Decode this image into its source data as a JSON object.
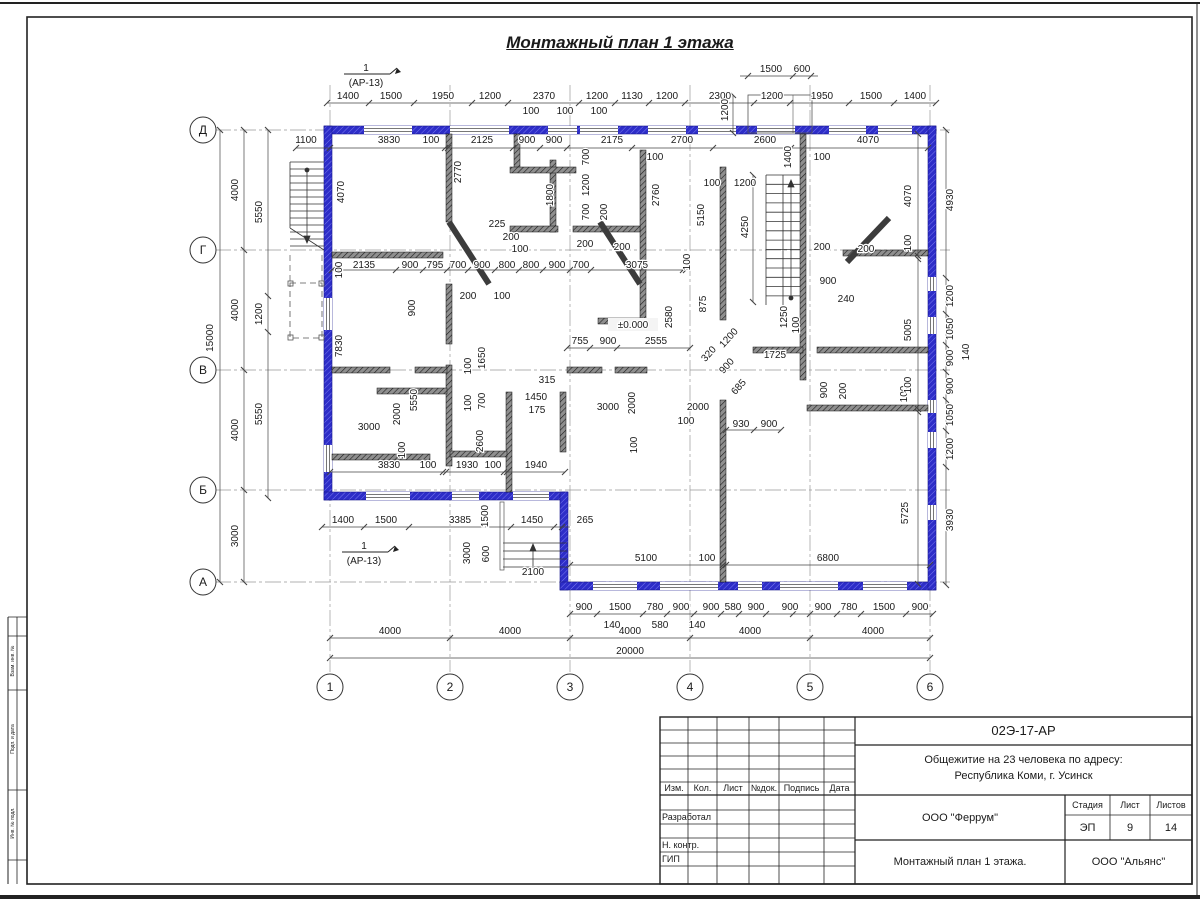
{
  "sheet": {
    "title": "Монтажный план 1 этажа",
    "stamp": {
      "doc_number": "02Э-17-АР",
      "project_line1": "Общежитие на 23 человека по адресу:",
      "project_line2": "Республика Коми, г. Усинск",
      "org_design": "ООО \"Феррум\"",
      "org_contractor": "ООО \"Альянс\"",
      "sheet_title": "Монтажный план 1 этажа.",
      "stage_label": "Стадия",
      "sheet_label": "Лист",
      "sheets_label": "Листов",
      "stage": "ЭП",
      "sheet_no": "9",
      "sheets_total": "14",
      "col_izm": "Изм.",
      "col_kol": "Кол.",
      "col_list": "Лист",
      "col_doc": "№док.",
      "col_sign": "Подпись",
      "col_date": "Дата",
      "row_developed": "Разработал",
      "row_ncontrol": "Н. контр.",
      "row_gip": "ГИП"
    },
    "side_labels": [
      "Взам. инв. №",
      "Подп. и дата",
      "Инв. № подл."
    ]
  },
  "plan": {
    "elevation": "±0.000",
    "section_marker": {
      "num": "1",
      "ref": "(АР-13)"
    },
    "axes": {
      "cols": [
        {
          "label": "1",
          "x": 330
        },
        {
          "label": "2",
          "x": 450
        },
        {
          "label": "3",
          "x": 570
        },
        {
          "label": "4",
          "x": 690
        },
        {
          "label": "5",
          "x": 810
        },
        {
          "label": "6",
          "x": 930
        }
      ],
      "rows": [
        {
          "label": "Д",
          "y": 130
        },
        {
          "label": "Г",
          "y": 250
        },
        {
          "label": "В",
          "y": 370
        },
        {
          "label": "Б",
          "y": 490
        },
        {
          "label": "А",
          "y": 582
        }
      ]
    },
    "dim_labels": [
      {
        "t": "1400",
        "x": 348,
        "y": 99
      },
      {
        "t": "1500",
        "x": 391,
        "y": 99
      },
      {
        "t": "1950",
        "x": 443,
        "y": 99
      },
      {
        "t": "1200",
        "x": 490,
        "y": 99
      },
      {
        "t": "2370",
        "x": 544,
        "y": 99
      },
      {
        "t": "1200",
        "x": 597,
        "y": 99
      },
      {
        "t": "1130",
        "x": 632,
        "y": 99
      },
      {
        "t": "1200",
        "x": 667,
        "y": 99
      },
      {
        "t": "2300",
        "x": 720,
        "y": 99
      },
      {
        "t": "1200",
        "x": 772,
        "y": 99
      },
      {
        "t": "1950",
        "x": 822,
        "y": 99
      },
      {
        "t": "1500",
        "x": 871,
        "y": 99
      },
      {
        "t": "1400",
        "x": 915,
        "y": 99
      },
      {
        "t": "1500",
        "x": 771,
        "y": 72
      },
      {
        "t": "600",
        "x": 802,
        "y": 72
      },
      {
        "t": "1200",
        "x": 728,
        "y": 110,
        "r": -90
      },
      {
        "t": "1100",
        "x": 306,
        "y": 143
      },
      {
        "t": "3830",
        "x": 389,
        "y": 143
      },
      {
        "t": "100",
        "x": 431,
        "y": 143
      },
      {
        "t": "2125",
        "x": 482,
        "y": 143
      },
      {
        "t": "900",
        "x": 527,
        "y": 143
      },
      {
        "t": "900",
        "x": 554,
        "y": 143
      },
      {
        "t": "2175",
        "x": 612,
        "y": 143
      },
      {
        "t": "2700",
        "x": 682,
        "y": 143
      },
      {
        "t": "2600",
        "x": 765,
        "y": 143
      },
      {
        "t": "4070",
        "x": 868,
        "y": 143
      },
      {
        "t": "100",
        "x": 531,
        "y": 114
      },
      {
        "t": "100",
        "x": 565,
        "y": 114
      },
      {
        "t": "100",
        "x": 599,
        "y": 114
      },
      {
        "t": "100",
        "x": 655,
        "y": 160
      },
      {
        "t": "1400",
        "x": 791,
        "y": 157,
        "r": -90
      },
      {
        "t": "100",
        "x": 822,
        "y": 160
      },
      {
        "t": "100",
        "x": 712,
        "y": 186
      },
      {
        "t": "1200",
        "x": 745,
        "y": 186
      },
      {
        "t": "15000",
        "x": 213,
        "y": 338,
        "r": -90
      },
      {
        "t": "4000",
        "x": 238,
        "y": 190,
        "r": -90
      },
      {
        "t": "4000",
        "x": 238,
        "y": 310,
        "r": -90
      },
      {
        "t": "4000",
        "x": 238,
        "y": 430,
        "r": -90
      },
      {
        "t": "3000",
        "x": 238,
        "y": 536,
        "r": -90
      },
      {
        "t": "5550",
        "x": 262,
        "y": 212,
        "r": -90
      },
      {
        "t": "1200",
        "x": 262,
        "y": 314,
        "r": -90
      },
      {
        "t": "5550",
        "x": 262,
        "y": 414,
        "r": -90
      },
      {
        "t": "4070",
        "x": 344,
        "y": 192,
        "r": -90
      },
      {
        "t": "100",
        "x": 342,
        "y": 270,
        "r": -90
      },
      {
        "t": "7830",
        "x": 342,
        "y": 346,
        "r": -90
      },
      {
        "t": "2770",
        "x": 461,
        "y": 172,
        "r": -90
      },
      {
        "t": "900",
        "x": 415,
        "y": 308,
        "r": -90
      },
      {
        "t": "5550",
        "x": 417,
        "y": 400,
        "r": -90
      },
      {
        "t": "2600",
        "x": 483,
        "y": 441,
        "r": -90
      },
      {
        "t": "2000",
        "x": 400,
        "y": 414,
        "r": -90
      },
      {
        "t": "100",
        "x": 405,
        "y": 450,
        "r": -90
      },
      {
        "t": "2135",
        "x": 364,
        "y": 268
      },
      {
        "t": "900",
        "x": 410,
        "y": 268
      },
      {
        "t": "795",
        "x": 435,
        "y": 268
      },
      {
        "t": "700",
        "x": 458,
        "y": 268
      },
      {
        "t": "900",
        "x": 482,
        "y": 268
      },
      {
        "t": "800",
        "x": 507,
        "y": 268
      },
      {
        "t": "800",
        "x": 531,
        "y": 268
      },
      {
        "t": "900",
        "x": 557,
        "y": 268
      },
      {
        "t": "700",
        "x": 581,
        "y": 268
      },
      {
        "t": "3075",
        "x": 637,
        "y": 268
      },
      {
        "t": "100",
        "x": 690,
        "y": 262,
        "r": -90
      },
      {
        "t": "225",
        "x": 497,
        "y": 227
      },
      {
        "t": "200",
        "x": 511,
        "y": 240
      },
      {
        "t": "100",
        "x": 520,
        "y": 252
      },
      {
        "t": "200",
        "x": 468,
        "y": 299
      },
      {
        "t": "100",
        "x": 502,
        "y": 299
      },
      {
        "t": "200",
        "x": 585,
        "y": 247
      },
      {
        "t": "200",
        "x": 622,
        "y": 250
      },
      {
        "t": "200",
        "x": 822,
        "y": 250
      },
      {
        "t": "200",
        "x": 866,
        "y": 252
      },
      {
        "t": "700",
        "x": 589,
        "y": 157,
        "r": -90
      },
      {
        "t": "1200",
        "x": 589,
        "y": 185,
        "r": -90
      },
      {
        "t": "700",
        "x": 589,
        "y": 212,
        "r": -90
      },
      {
        "t": "200",
        "x": 607,
        "y": 212,
        "r": -90
      },
      {
        "t": "1800",
        "x": 553,
        "y": 195,
        "r": -90
      },
      {
        "t": "2760",
        "x": 659,
        "y": 195,
        "r": -90
      },
      {
        "t": "5150",
        "x": 704,
        "y": 215,
        "r": -90
      },
      {
        "t": "4250",
        "x": 748,
        "y": 227,
        "r": -90
      },
      {
        "t": "900",
        "x": 828,
        "y": 284
      },
      {
        "t": "240",
        "x": 846,
        "y": 302
      },
      {
        "t": "875",
        "x": 706,
        "y": 304,
        "r": -90
      },
      {
        "t": "2580",
        "x": 672,
        "y": 317,
        "r": -90
      },
      {
        "t": "1250",
        "x": 787,
        "y": 317,
        "r": -90
      },
      {
        "t": "100",
        "x": 799,
        "y": 325,
        "r": -90
      },
      {
        "t": "1725",
        "x": 775,
        "y": 358
      },
      {
        "t": "1200",
        "x": 731,
        "y": 340,
        "r": -48
      },
      {
        "t": "320",
        "x": 711,
        "y": 356,
        "r": -48
      },
      {
        "t": "900",
        "x": 729,
        "y": 368,
        "r": -48
      },
      {
        "t": "685",
        "x": 741,
        "y": 389,
        "r": -48
      },
      {
        "t": "900",
        "x": 827,
        "y": 390,
        "r": -90
      },
      {
        "t": "200",
        "x": 846,
        "y": 391,
        "r": -90
      },
      {
        "t": "100",
        "x": 907,
        "y": 394,
        "r": -90
      },
      {
        "t": "755",
        "x": 580,
        "y": 344
      },
      {
        "t": "900",
        "x": 608,
        "y": 344
      },
      {
        "t": "2555",
        "x": 656,
        "y": 344
      },
      {
        "t": "315",
        "x": 547,
        "y": 383
      },
      {
        "t": "1450",
        "x": 536,
        "y": 400
      },
      {
        "t": "175",
        "x": 537,
        "y": 413
      },
      {
        "t": "3000",
        "x": 608,
        "y": 410
      },
      {
        "t": "2000",
        "x": 635,
        "y": 403,
        "r": -90
      },
      {
        "t": "2000",
        "x": 698,
        "y": 410
      },
      {
        "t": "100",
        "x": 686,
        "y": 424
      },
      {
        "t": "930",
        "x": 741,
        "y": 427
      },
      {
        "t": "900",
        "x": 769,
        "y": 427
      },
      {
        "t": "100",
        "x": 637,
        "y": 445,
        "r": -90
      },
      {
        "t": "100",
        "x": 471,
        "y": 366,
        "r": -90
      },
      {
        "t": "1650",
        "x": 485,
        "y": 358,
        "r": -90
      },
      {
        "t": "100",
        "x": 471,
        "y": 403,
        "r": -90
      },
      {
        "t": "700",
        "x": 485,
        "y": 401,
        "r": -90
      },
      {
        "t": "3000",
        "x": 369,
        "y": 430
      },
      {
        "t": "3830",
        "x": 389,
        "y": 468
      },
      {
        "t": "100",
        "x": 428,
        "y": 468
      },
      {
        "t": "1930",
        "x": 467,
        "y": 468
      },
      {
        "t": "100",
        "x": 493,
        "y": 468
      },
      {
        "t": "1940",
        "x": 536,
        "y": 468
      },
      {
        "t": "1400",
        "x": 343,
        "y": 523
      },
      {
        "t": "1500",
        "x": 386,
        "y": 523
      },
      {
        "t": "3385",
        "x": 460,
        "y": 523
      },
      {
        "t": "1450",
        "x": 532,
        "y": 523
      },
      {
        "t": "265",
        "x": 585,
        "y": 523
      },
      {
        "t": "1500",
        "x": 488,
        "y": 516,
        "r": -90
      },
      {
        "t": "3000",
        "x": 470,
        "y": 553,
        "r": -90
      },
      {
        "t": "600",
        "x": 489,
        "y": 554,
        "r": -90
      },
      {
        "t": "2100",
        "x": 533,
        "y": 575
      },
      {
        "t": "5100",
        "x": 646,
        "y": 561
      },
      {
        "t": "100",
        "x": 707,
        "y": 561
      },
      {
        "t": "6800",
        "x": 828,
        "y": 561
      },
      {
        "t": "4070",
        "x": 911,
        "y": 196,
        "r": -90
      },
      {
        "t": "100",
        "x": 911,
        "y": 243,
        "r": -90
      },
      {
        "t": "5005",
        "x": 911,
        "y": 330,
        "r": -90
      },
      {
        "t": "100",
        "x": 911,
        "y": 385,
        "r": -90
      },
      {
        "t": "5725",
        "x": 908,
        "y": 513,
        "r": -90
      },
      {
        "t": "4930",
        "x": 953,
        "y": 200,
        "r": -90
      },
      {
        "t": "1200",
        "x": 953,
        "y": 296,
        "r": -90
      },
      {
        "t": "1050",
        "x": 953,
        "y": 329,
        "r": -90
      },
      {
        "t": "900",
        "x": 953,
        "y": 358,
        "r": -90
      },
      {
        "t": "900",
        "x": 953,
        "y": 386,
        "r": -90
      },
      {
        "t": "1050",
        "x": 953,
        "y": 415,
        "r": -90
      },
      {
        "t": "1200",
        "x": 953,
        "y": 449,
        "r": -90
      },
      {
        "t": "3930",
        "x": 953,
        "y": 520,
        "r": -90
      },
      {
        "t": "140",
        "x": 969,
        "y": 352,
        "r": -90
      },
      {
        "t": "900",
        "x": 584,
        "y": 610
      },
      {
        "t": "1500",
        "x": 620,
        "y": 610
      },
      {
        "t": "780",
        "x": 655,
        "y": 610
      },
      {
        "t": "900",
        "x": 681,
        "y": 610
      },
      {
        "t": "900",
        "x": 711,
        "y": 610
      },
      {
        "t": "580",
        "x": 733,
        "y": 610
      },
      {
        "t": "900",
        "x": 756,
        "y": 610
      },
      {
        "t": "900",
        "x": 790,
        "y": 610
      },
      {
        "t": "900",
        "x": 823,
        "y": 610
      },
      {
        "t": "780",
        "x": 849,
        "y": 610
      },
      {
        "t": "1500",
        "x": 884,
        "y": 610
      },
      {
        "t": "900",
        "x": 920,
        "y": 610
      },
      {
        "t": "140",
        "x": 612,
        "y": 628
      },
      {
        "t": "580",
        "x": 660,
        "y": 628
      },
      {
        "t": "140",
        "x": 697,
        "y": 628
      },
      {
        "t": "4000",
        "x": 390,
        "y": 634
      },
      {
        "t": "4000",
        "x": 510,
        "y": 634
      },
      {
        "t": "4000",
        "x": 630,
        "y": 634
      },
      {
        "t": "4000",
        "x": 750,
        "y": 634
      },
      {
        "t": "4000",
        "x": 873,
        "y": 634
      },
      {
        "t": "20000",
        "x": 630,
        "y": 654
      }
    ]
  }
}
